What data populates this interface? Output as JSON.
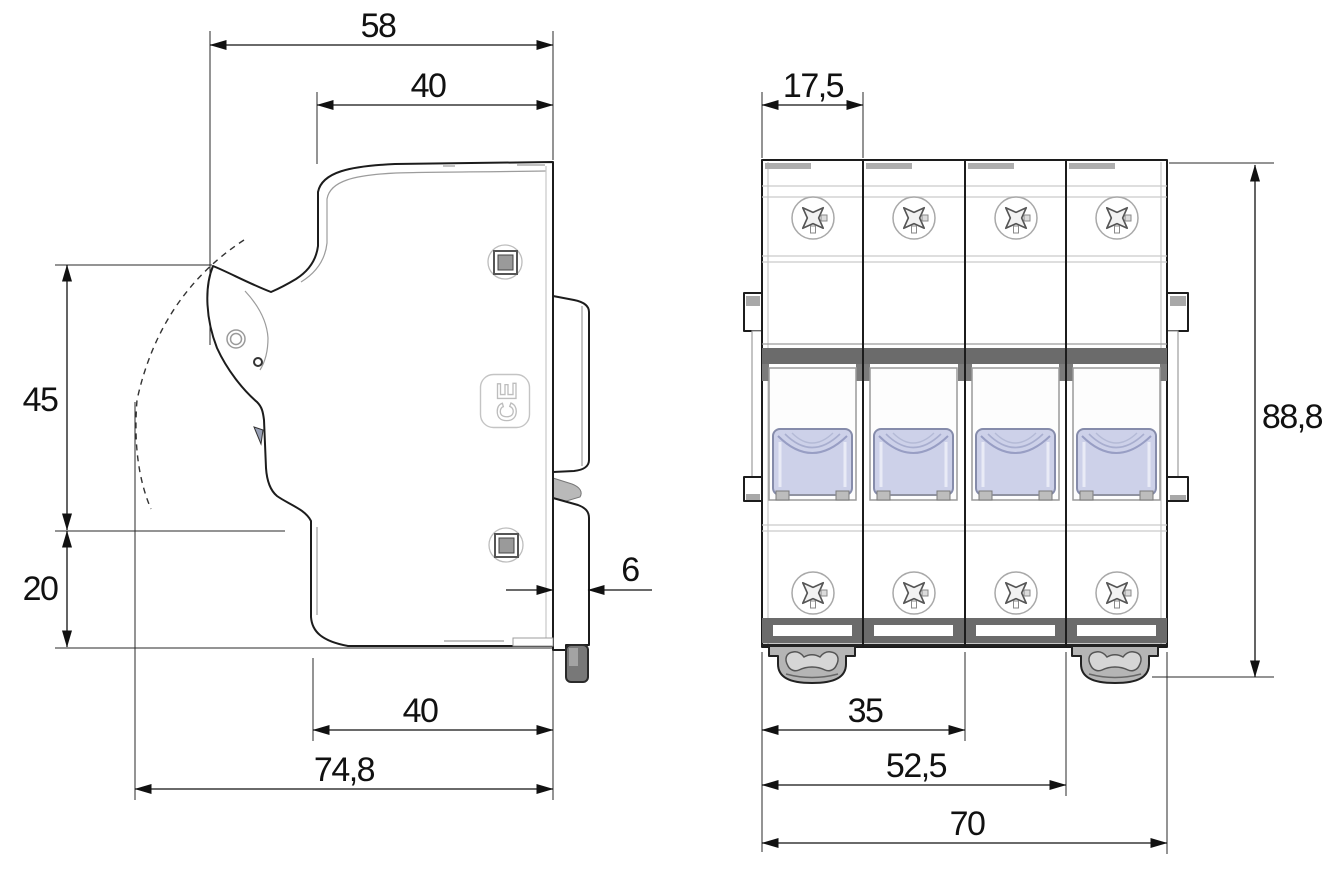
{
  "side_view": {
    "label": "side-view",
    "ce_mark": "CE",
    "dims": {
      "overall_width": "58",
      "upper_front_width": "40",
      "handle_zone_height": "45",
      "lower_zone_height": "20",
      "lower_front_width": "40",
      "overall_depth": "74,8",
      "rail_standoff": "6"
    }
  },
  "front_view": {
    "label": "front-view",
    "pole_count": 4,
    "dims": {
      "module_width": "17,5",
      "overall_height": "88,8",
      "two_module_width": "35",
      "three_module_width": "52,5",
      "overall_width": "70"
    }
  },
  "colors": {
    "background": "#ffffff",
    "outline": "#1c1c1c",
    "dark_band": "#6b6b6b",
    "handle_fill": "#cdd1e9",
    "handle_stroke": "#868cab",
    "clip_fill": "#b5b5b5",
    "rail_foot": "#787878"
  }
}
